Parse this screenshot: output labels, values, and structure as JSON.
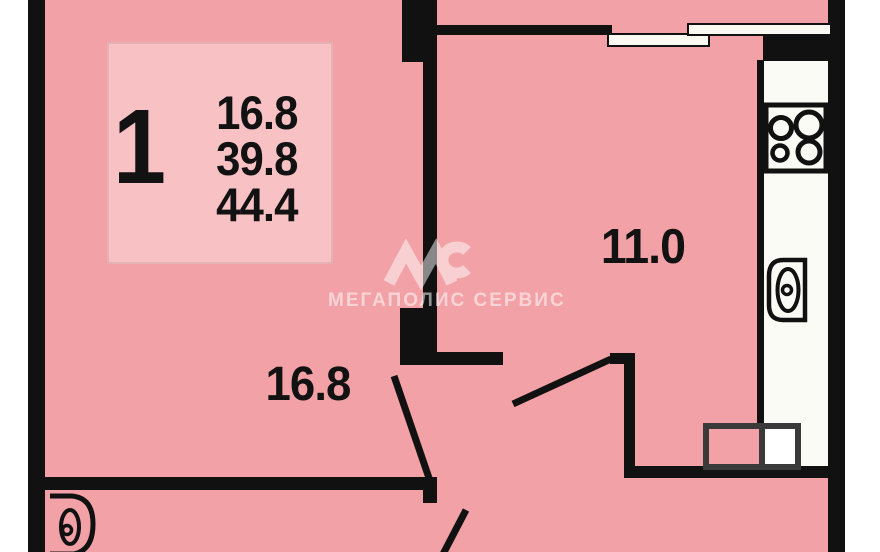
{
  "info_box": {
    "room_count": "1",
    "values": [
      "16.8",
      "39.8",
      "44.4"
    ]
  },
  "rooms": {
    "kitchen": {
      "area": "11.0"
    },
    "living": {
      "area": "16.8"
    }
  },
  "watermark": {
    "text": "МЕГАПОЛИС СЕРВИС",
    "logo": "MC"
  },
  "colors": {
    "floor_pink": "#F2A1A6",
    "info_box_pink": "#F8C1C4",
    "wall_black": "#111111",
    "counter_white": "#FBFBF6",
    "cabinet_outline": "#3A3A3A",
    "watermark_white_alpha": "rgba(255,255,255,0.55)"
  }
}
